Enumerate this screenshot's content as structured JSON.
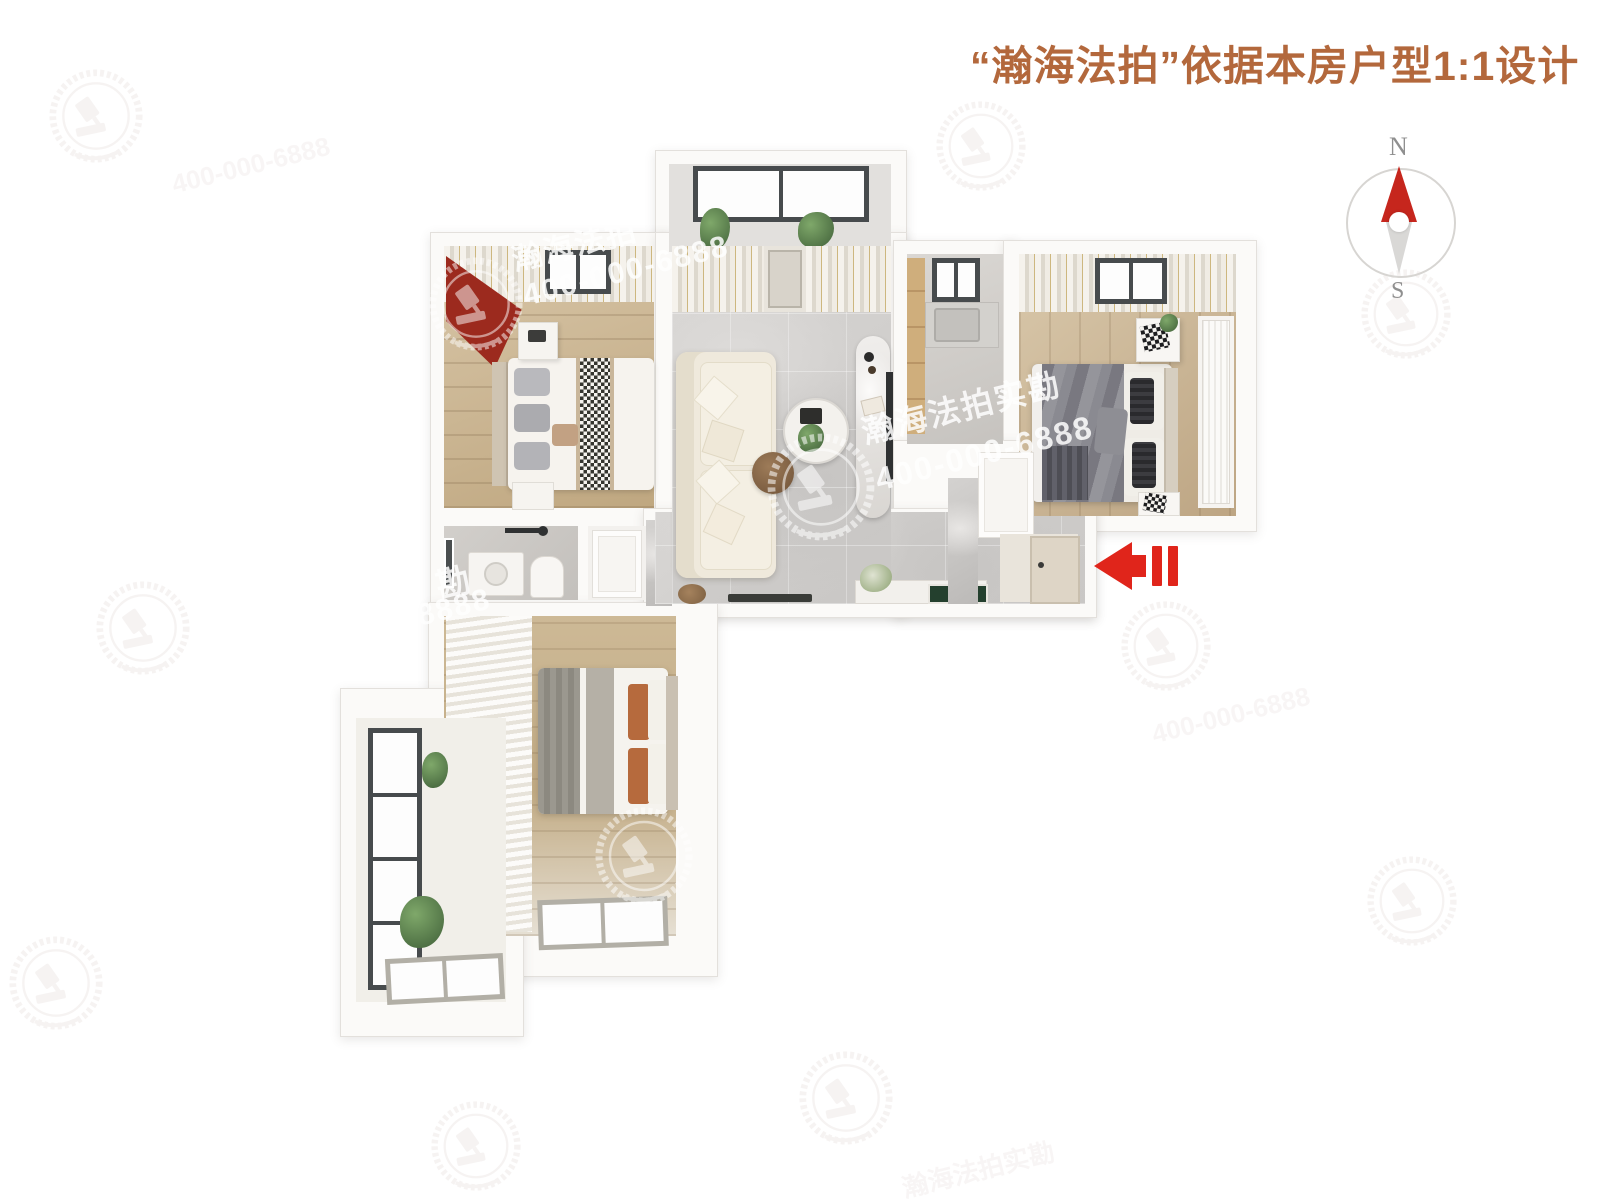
{
  "header": {
    "title": "“瀚海法拍”依据本房户型1:1设计",
    "title_color": "#b3683c"
  },
  "compass": {
    "north": "N",
    "south": "S",
    "needle_north_color": "#c6261d",
    "needle_south_color": "#d9d8d6"
  },
  "entrance_arrow": {
    "color": "#e0251b",
    "direction": "left"
  },
  "watermarks": {
    "brand": "瀚海法拍",
    "brand_full": "瀚海法拍实勘",
    "phone": "400-000-6888",
    "fragments": {
      "kan": "勘",
      "eights": "8888"
    },
    "logo_name": "gavel-wreath-logo",
    "text_color": "#ffffff"
  }
}
